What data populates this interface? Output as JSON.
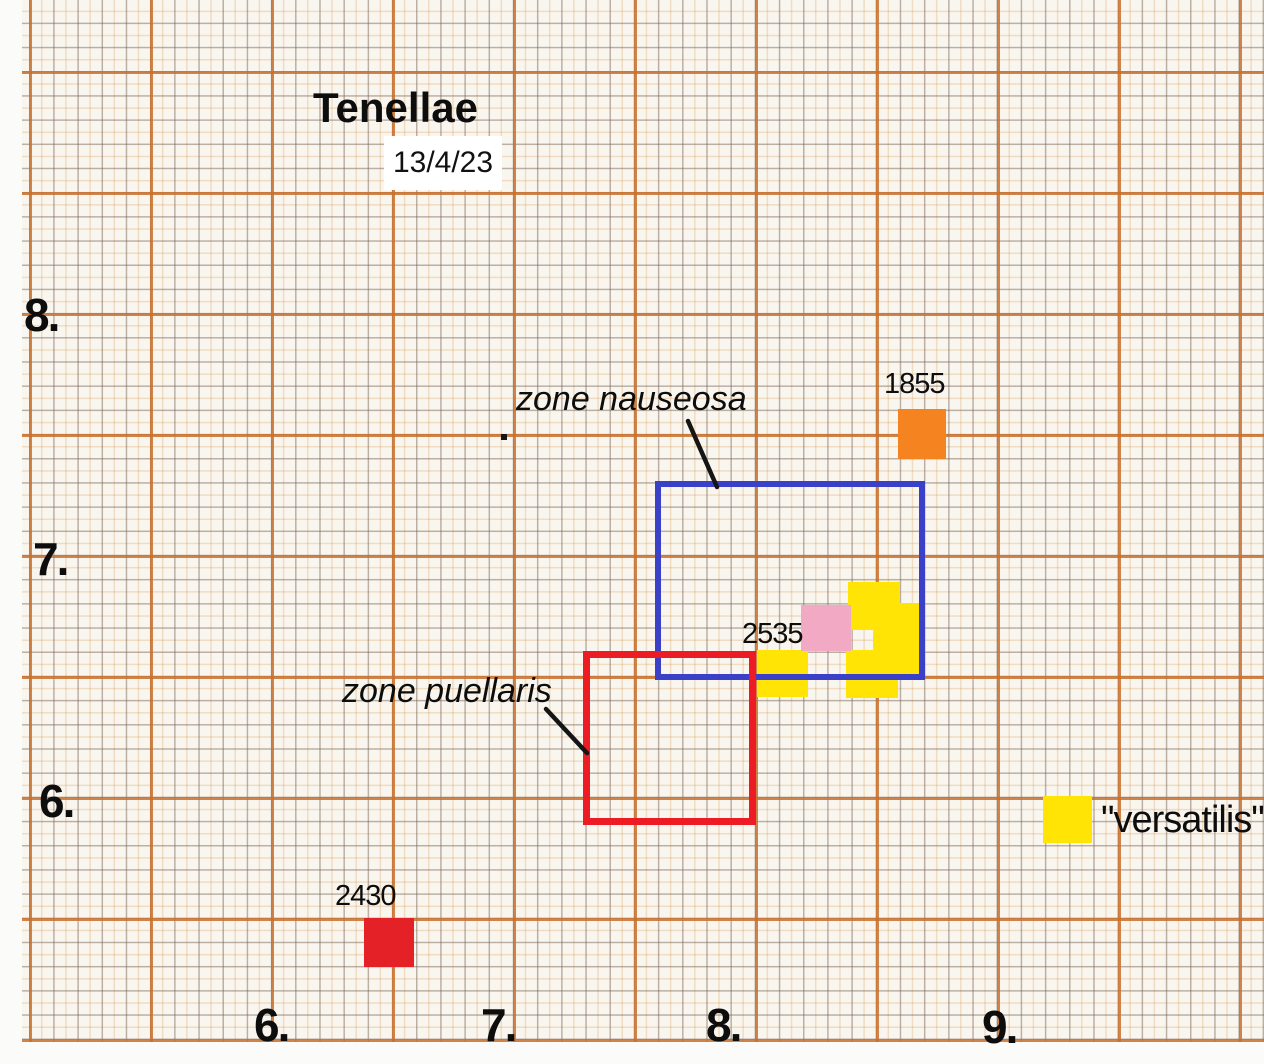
{
  "chart_data": {
    "type": "scatter",
    "title": "Tenellae",
    "date_label": "13/4/23",
    "notes": "Specimen map drawn on orange graph paper; squares mark samples, outlined rectangles mark zones.",
    "axes": {
      "x": {
        "label": "",
        "range": [
          5.9,
          10.1
        ],
        "ticks": [
          {
            "label": "6.",
            "value": 6,
            "px": {
              "left": 254,
              "top": 998
            }
          },
          {
            "label": "7.",
            "value": 7,
            "px": {
              "left": 481,
              "top": 998
            }
          },
          {
            "label": "8.",
            "value": 8,
            "px": {
              "left": 706,
              "top": 998
            }
          },
          {
            "label": "9.",
            "value": 9,
            "px": {
              "left": 982,
              "top": 1000
            }
          }
        ]
      },
      "y": {
        "label": "",
        "range": [
          5.0,
          8.6
        ],
        "ticks": [
          {
            "label": "8.",
            "value": 8,
            "px": {
              "left": 24,
              "top": 288
            }
          },
          {
            "label": "7.",
            "value": 7,
            "px": {
              "left": 33,
              "top": 532
            }
          },
          {
            "label": "6.",
            "value": 6,
            "px": {
              "left": 39,
              "top": 774
            }
          }
        ]
      },
      "grid": {
        "minor_step_units": 0.1,
        "major_step_units": 0.5,
        "minor_px": 24.2,
        "major_px": 121
      }
    },
    "points": [
      {
        "id": "versatilis-top",
        "series": "versatilis",
        "label": "",
        "color": "#ffe405",
        "x": 8.5,
        "y": 6.8,
        "px": {
          "left": 848,
          "top": 582,
          "w": 52,
          "h": 48
        }
      },
      {
        "id": "versatilis-right",
        "series": "versatilis",
        "label": "",
        "color": "#ffe405",
        "x": 8.6,
        "y": 6.65,
        "px": {
          "left": 873,
          "top": 603,
          "w": 48,
          "h": 72
        }
      },
      {
        "id": "versatilis-bottom",
        "series": "versatilis",
        "label": "",
        "color": "#ffe405",
        "x": 8.5,
        "y": 6.5,
        "px": {
          "left": 846,
          "top": 650,
          "w": 52,
          "h": 48
        }
      },
      {
        "id": "versatilis-left",
        "series": "versatilis",
        "label": "",
        "color": "#ffe405",
        "x": 8.1,
        "y": 6.5,
        "px": {
          "left": 757,
          "top": 650,
          "w": 51,
          "h": 47
        }
      },
      {
        "id": "2535",
        "series": "sample",
        "label": "2535",
        "color": "#f2a9c4",
        "x": 8.3,
        "y": 6.7,
        "px": {
          "left": 801,
          "top": 605,
          "w": 50,
          "h": 46
        },
        "label_px": {
          "left": 742,
          "top": 618
        }
      },
      {
        "id": "1855",
        "series": "sample",
        "label": "1855",
        "color": "#f5831f",
        "x": 8.7,
        "y": 7.5,
        "px": {
          "left": 898,
          "top": 409,
          "w": 48,
          "h": 50
        },
        "label_px": {
          "left": 884,
          "top": 368
        }
      },
      {
        "id": "2430",
        "series": "sample",
        "label": "2430",
        "color": "#e32127",
        "x": 6.5,
        "y": 5.4,
        "px": {
          "left": 364,
          "top": 918,
          "w": 50,
          "h": 49
        },
        "label_px": {
          "left": 335,
          "top": 880
        }
      }
    ],
    "zones": [
      {
        "id": "nauseosa",
        "label": "zone nauseosa",
        "color": "#3a41c8",
        "stroke": 6,
        "x_range": [
          7.6,
          8.7
        ],
        "y_range": [
          6.5,
          7.3
        ],
        "px": {
          "left": 655,
          "top": 481,
          "w": 270,
          "h": 199
        },
        "label_px": {
          "left": 516,
          "top": 380
        },
        "pointer": {
          "x1": 688,
          "y1": 421,
          "x2": 717,
          "y2": 487
        }
      },
      {
        "id": "puellaris",
        "label": "zone puellaris",
        "color": "#ec1b24",
        "stroke": 7,
        "x_range": [
          7.3,
          8.0
        ],
        "y_range": [
          5.9,
          6.6
        ],
        "px": {
          "left": 583,
          "top": 651,
          "w": 173,
          "h": 174
        },
        "label_px": {
          "left": 342,
          "top": 672
        },
        "pointer": {
          "x1": 546,
          "y1": 709,
          "x2": 587,
          "y2": 753
        }
      }
    ],
    "legend": {
      "label": "\"versatilis\"",
      "swatch_color": "#ffe405",
      "swatch_px": {
        "left": 1043,
        "top": 796,
        "w": 49,
        "h": 47
      },
      "label_px": {
        "left": 1101,
        "top": 799
      }
    },
    "title_px": {
      "left": 313,
      "top": 84
    },
    "date_box_px": {
      "left": 384,
      "top": 136,
      "w": 118,
      "h": 54
    },
    "ink_dot_px": {
      "left": 501,
      "top": 434,
      "size": 6
    },
    "pointer_color": "#151515"
  }
}
